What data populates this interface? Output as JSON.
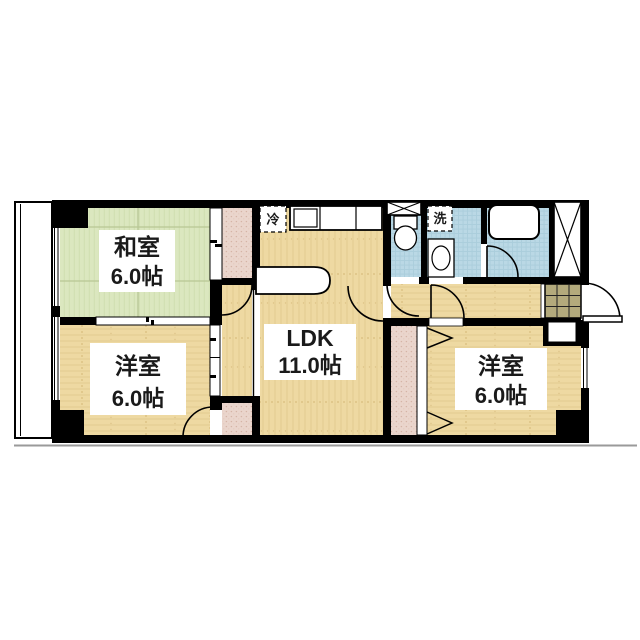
{
  "floor_plan": {
    "rooms": [
      {
        "name": "和室",
        "size": "6.0帖",
        "type": "japanese-tatami-room"
      },
      {
        "name": "洋室",
        "size": "6.0帖",
        "type": "western-room-left"
      },
      {
        "name": "LDK",
        "size": "11.0帖",
        "type": "living-dining-kitchen"
      },
      {
        "name": "洋室",
        "size": "6.0帖",
        "type": "western-room-right"
      }
    ],
    "fixtures": {
      "refrigerator_label": "冷",
      "washer_label": "洗"
    },
    "colors": {
      "wall": "#000000",
      "tatami_floor": "#dbe7bf",
      "wood_floor": "#eed9a2",
      "wet_room_floor": "#bad8e5",
      "closet_fill": "#ead5cc",
      "entry_tile": "#b3aa7c",
      "ground_line": "#9a9a9a"
    }
  }
}
